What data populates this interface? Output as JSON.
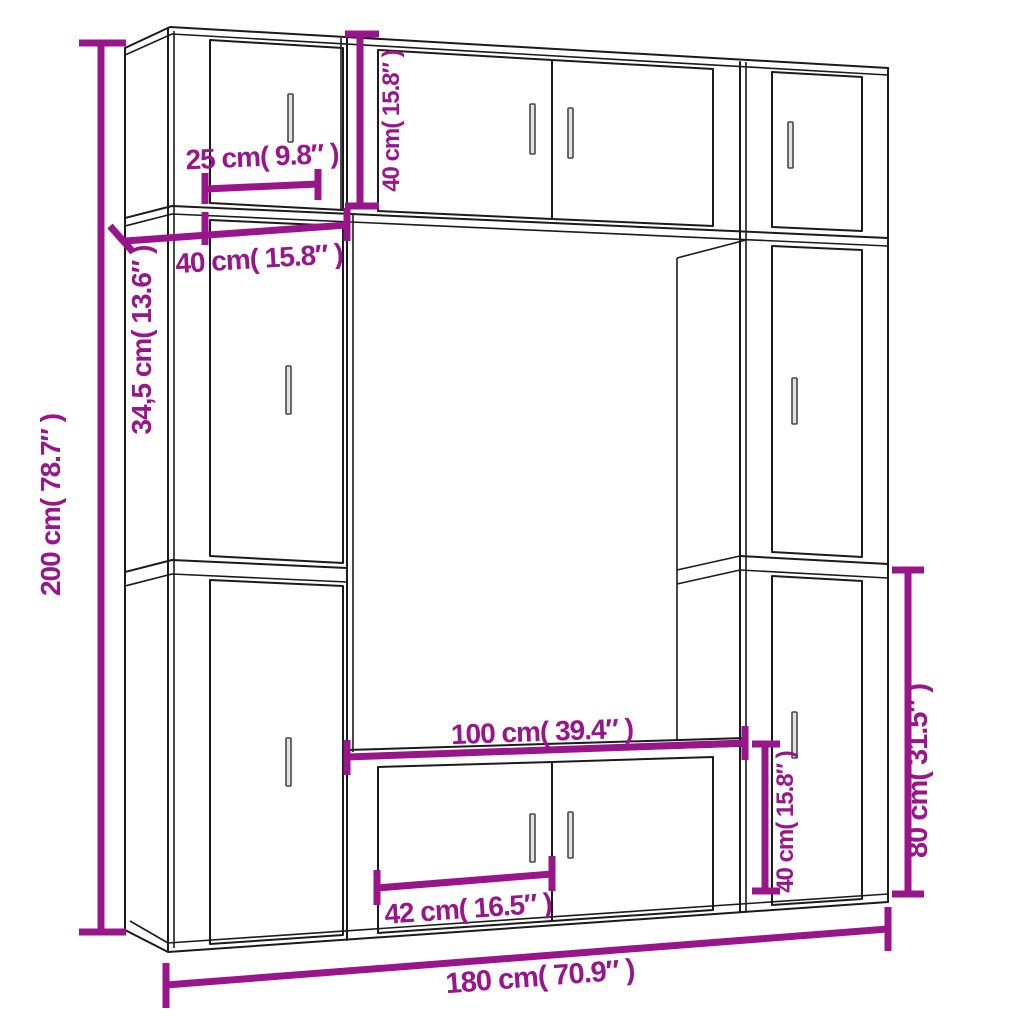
{
  "diagram": {
    "type": "furniture-dimension-diagram",
    "description": "Line drawing of a wall-mounted TV cabinet set (open center niche, stacked side cabinets, top bridge cabinet and TV stand) annotated with magenta dimension lines",
    "colors": {
      "dimension": "#98158A",
      "outline": "#1b1b1b",
      "background": "#ffffff",
      "handle_fill": "#e2e2e2"
    },
    "dimensions": [
      {
        "id": "total-height",
        "text": "200 cm( 78.7″ )",
        "orientation": "vertical"
      },
      {
        "id": "top-cabinet-depth",
        "text": "25 cm( 9.8″ )",
        "orientation": "horizontal"
      },
      {
        "id": "top-row-height",
        "text": "40 cm( 15.8″ )",
        "orientation": "vertical"
      },
      {
        "id": "side-column-width",
        "text": "40 cm( 15.8″ )",
        "orientation": "horizontal"
      },
      {
        "id": "side-column-depth",
        "text": "34,5 cm( 13.6″ )",
        "orientation": "vertical"
      },
      {
        "id": "tv-stand-width",
        "text": "100 cm( 39.4″ )",
        "orientation": "horizontal"
      },
      {
        "id": "tv-stand-door-width",
        "text": "42 cm( 16.5″ )",
        "orientation": "horizontal"
      },
      {
        "id": "tv-stand-height",
        "text": "40 cm( 15.8″ )",
        "orientation": "vertical"
      },
      {
        "id": "lower-cabinet-height",
        "text": "80 cm( 31.5″ )",
        "orientation": "vertical"
      },
      {
        "id": "total-width",
        "text": "180 cm( 70.9″ )",
        "orientation": "horizontal"
      }
    ]
  }
}
